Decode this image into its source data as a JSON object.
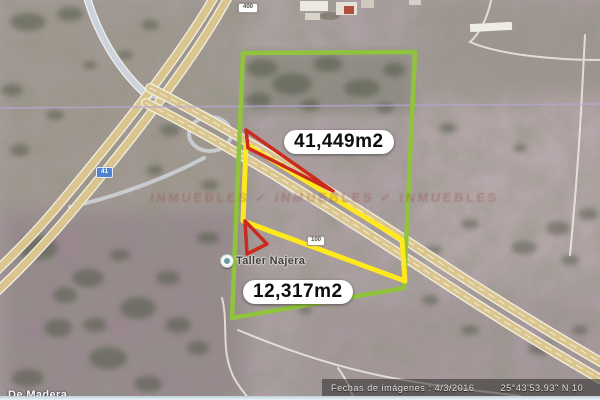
{
  "map": {
    "area_labels": [
      {
        "text": "41,449m2"
      },
      {
        "text": "12,317m2"
      }
    ],
    "route_shields": [
      {
        "label": "400"
      },
      {
        "label": "41"
      },
      {
        "label": "100"
      }
    ],
    "places": [
      {
        "name": "Taller Najera"
      },
      {
        "name": "De Madera"
      }
    ],
    "watermark": "INMUEBLES ✓ INMUEBLES ✓ INMUEBLES",
    "status_bar": {
      "dates": "Fechas de imágenes : 4/3/2016",
      "coordinates": "25°43'53.93\" N  10"
    },
    "colors": {
      "parcel_green": "#8fc43c",
      "parcel_yellow": "#ffe81e",
      "parcel_red": "#cc2a1e",
      "road_fill": "#dac58f",
      "boundary_line": "#b7a8d8",
      "label_bg": "#ffffff",
      "label_text": "#0d0d0d"
    }
  }
}
